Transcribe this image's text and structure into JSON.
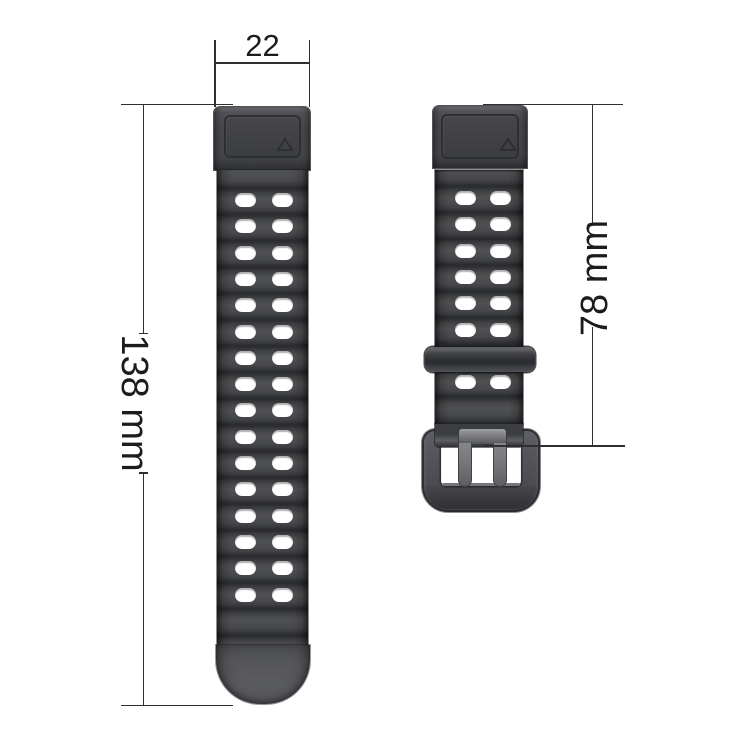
{
  "annotations": {
    "width_mm": "22",
    "long_strap_length": "138 mm",
    "short_strap_length": "78 mm"
  },
  "colors": {
    "background": "#ffffff",
    "dimension_line": "#2f2f2f",
    "dimension_text": "#1c1c1e",
    "strap_base": "#46474a",
    "strap_groove": "#2c2d30",
    "strap_highlight": "#4f5053",
    "strap_tail": "#55565a",
    "lug_plate": "#3c3d41",
    "keeper": "#303134",
    "buckle_frame": "#52535a",
    "buckle_prong": "#7d7e82",
    "hole": "#ffffff"
  },
  "left_strap": {
    "holes": {
      "columns_x": [
        18,
        55
      ],
      "first_row_center_y": 30,
      "row_spacing": 26.3,
      "row_count": 16,
      "hole_width": 21,
      "hole_height": 14
    }
  },
  "right_strap": {
    "holes": {
      "columns_x": [
        19.5,
        54.5
      ],
      "row_centers_y": [
        28,
        54.3,
        80.6,
        106.9,
        133.2,
        159.5,
        212.1
      ],
      "hole_width": 21,
      "hole_height": 14
    }
  }
}
